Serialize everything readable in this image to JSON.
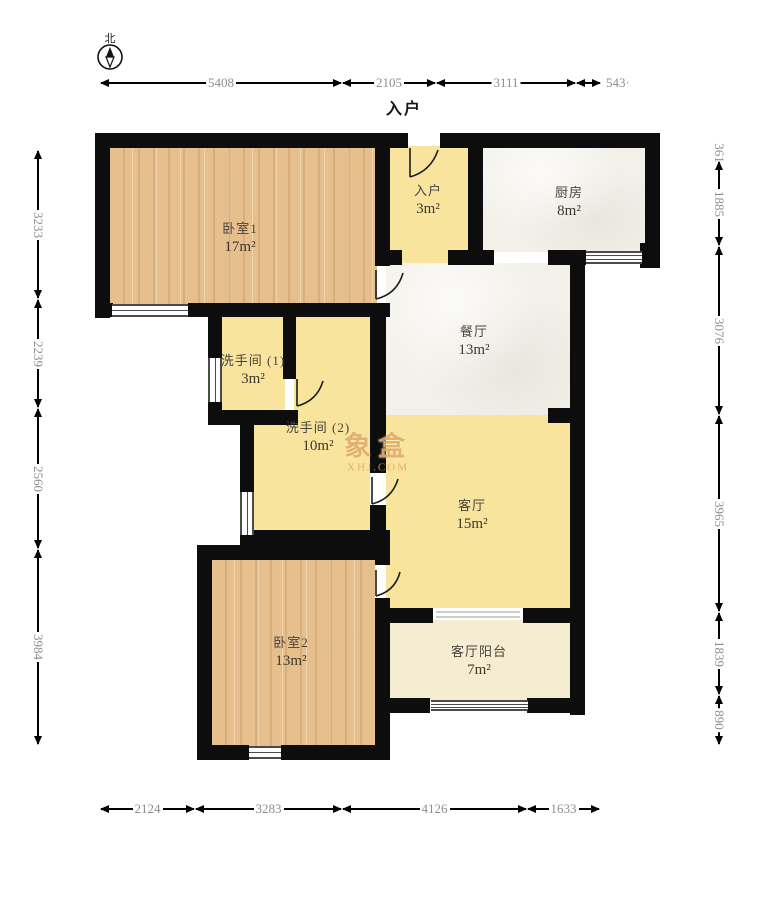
{
  "header": {
    "entry_direction_label": "入户"
  },
  "compass": {
    "label": "北"
  },
  "watermark": {
    "brand": "象盒",
    "site": "XHJ.COM"
  },
  "rooms": [
    {
      "id": "bedroom-1",
      "name": "卧室1",
      "area": "17m²",
      "floor": "wood"
    },
    {
      "id": "entry",
      "name": "入户",
      "area": "3m²",
      "floor": "yellow"
    },
    {
      "id": "kitchen",
      "name": "厨房",
      "area": "8m²",
      "floor": "marble"
    },
    {
      "id": "dining-room",
      "name": "餐厅",
      "area": "13m²",
      "floor": "marble"
    },
    {
      "id": "bathroom-1",
      "name": "洗手间 (1)",
      "area": "3m²",
      "floor": "yellow"
    },
    {
      "id": "bathroom-2",
      "name": "洗手间 (2)",
      "area": "10m²",
      "floor": "yellow"
    },
    {
      "id": "living-room",
      "name": "客厅",
      "area": "15m²",
      "floor": "yellow"
    },
    {
      "id": "bedroom-2",
      "name": "卧室2",
      "area": "13m²",
      "floor": "wood"
    },
    {
      "id": "living-room-balcony",
      "name": "客厅阳台",
      "area": "7m²",
      "floor": "cream"
    }
  ],
  "dimensions_mm": {
    "top": [
      "5408",
      "2105",
      "3111",
      "543·"
    ],
    "bottom": [
      "2124",
      "3283",
      "4126",
      "1633"
    ],
    "left": [
      "3233",
      "2239",
      "2560",
      "3984"
    ],
    "right": [
      "361",
      "1885",
      "3076",
      "3965",
      "1839",
      "890"
    ]
  },
  "colors": {
    "wall": "#0d0d0d",
    "wood_floor": "#e6bf8d",
    "tile_yellow": "#f8e49c",
    "tile_marble": "#f2f0e9",
    "balcony_cream": "#f5edd2",
    "dimension_text": "#8e8e8e",
    "watermark": "#dda85c"
  }
}
